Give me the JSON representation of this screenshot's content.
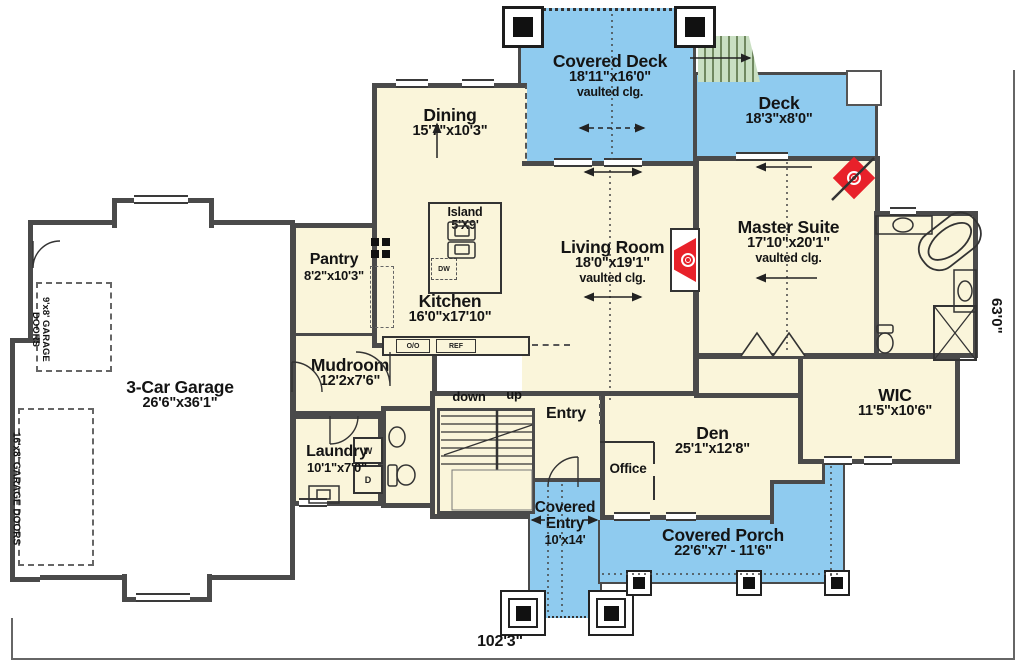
{
  "rooms": {
    "covered_deck": {
      "name": "Covered Deck",
      "dims": "18'11\"x16'0\"",
      "note": "vaulted clg."
    },
    "deck": {
      "name": "Deck",
      "dims": "18'3\"x8'0\""
    },
    "dining": {
      "name": "Dining",
      "dims": "15'7\"x10'3\""
    },
    "living_room": {
      "name": "Living Room",
      "dims": "18'0\"x19'1\"",
      "note": "vaulted clg."
    },
    "master_suite": {
      "name": "Master Suite",
      "dims": "17'10\"x20'1\"",
      "note": "vaulted clg."
    },
    "kitchen": {
      "name": "Kitchen",
      "dims": "16'0\"x17'10\""
    },
    "island": {
      "name": "Island",
      "dims": "5'X9'"
    },
    "pantry": {
      "name": "Pantry",
      "dims": "8'2\"x10'3\""
    },
    "mudroom": {
      "name": "Mudroom",
      "dims": "12'2x7'6\""
    },
    "garage": {
      "name": "3-Car Garage",
      "dims": "26'6\"x36'1\""
    },
    "laundry": {
      "name": "Laundry",
      "dims": "10'1\"x7'0\""
    },
    "entry": {
      "name": "Entry"
    },
    "den": {
      "name": "Den",
      "dims": "25'1\"x12'8\""
    },
    "office": {
      "name": "Office"
    },
    "wic": {
      "name": "WIC",
      "dims": "11'5\"x10'6\""
    },
    "covered_entry": {
      "name": "Covered Entry",
      "dims": "10'x14'"
    },
    "covered_porch": {
      "name": "Covered Porch",
      "dims": "22'6\"x7' - 11'6\""
    }
  },
  "stair_labels": {
    "down": "down",
    "up": "up"
  },
  "appliance_labels": {
    "dw": "DW",
    "double_oven": "O/O",
    "fridge": "REF",
    "washer": "W",
    "dryer": "D"
  },
  "garage_door_labels": {
    "small": "9'x8' GARAGE DOORS",
    "large": "16'x8' GARAGE DOORS"
  },
  "dimensions": {
    "overall_width": "102'3\"",
    "overall_depth": "63'0\""
  },
  "colors": {
    "deck_blue": "#8FCBEF",
    "floor_cream": "#FAF5DA",
    "stair_green": "#C9DFC2",
    "fireplace_red": "#E8212A",
    "wall_gray": "#4A4A4A"
  }
}
